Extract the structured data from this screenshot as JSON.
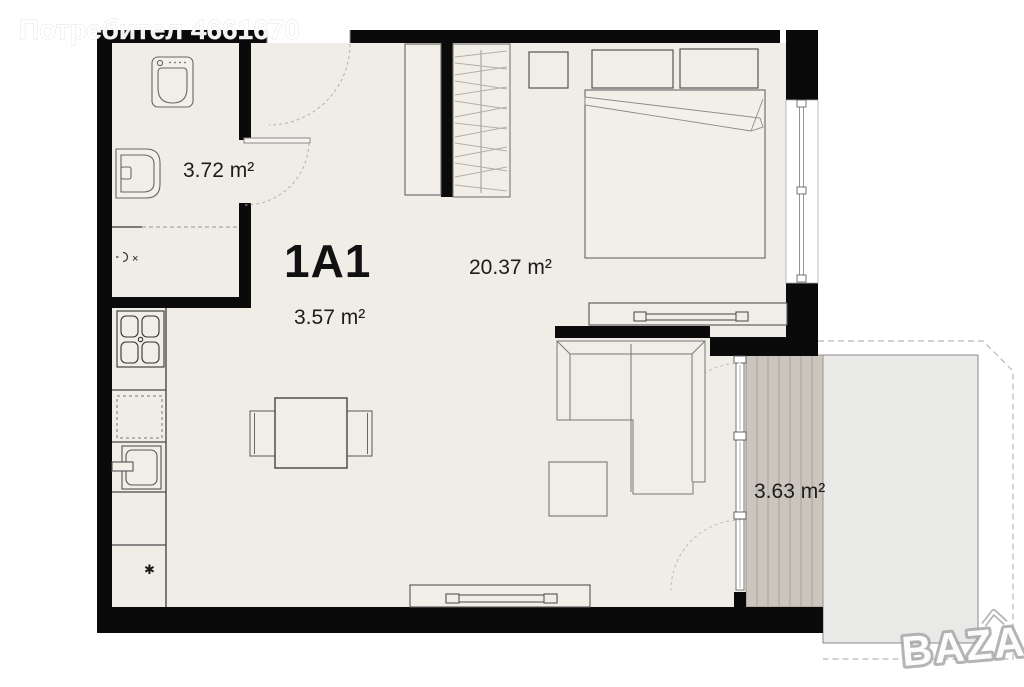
{
  "watermark": {
    "user_label": "Потребител 4661670"
  },
  "unit": {
    "id": "1A1"
  },
  "areas": {
    "bathroom": "3.72 m²",
    "entry": "3.57 m²",
    "living": "20.37 m²",
    "terrace": "3.63 m²"
  },
  "symbols": {
    "appliance_asterisk": "✱",
    "washer_cross": "×"
  },
  "logo": {
    "brand": "BAZAR"
  },
  "colors": {
    "wall": "#0a0a0a",
    "floor": "#f0ece6",
    "furniture_fill": "#f1eee8",
    "decking": "#cac5bd",
    "decking_line": "#a9a49c",
    "terrace": "#e9e9e7",
    "label_text": "#1c1c1c",
    "watermark_text": "#ffffff",
    "logo_outline": "#a9a9a9"
  }
}
